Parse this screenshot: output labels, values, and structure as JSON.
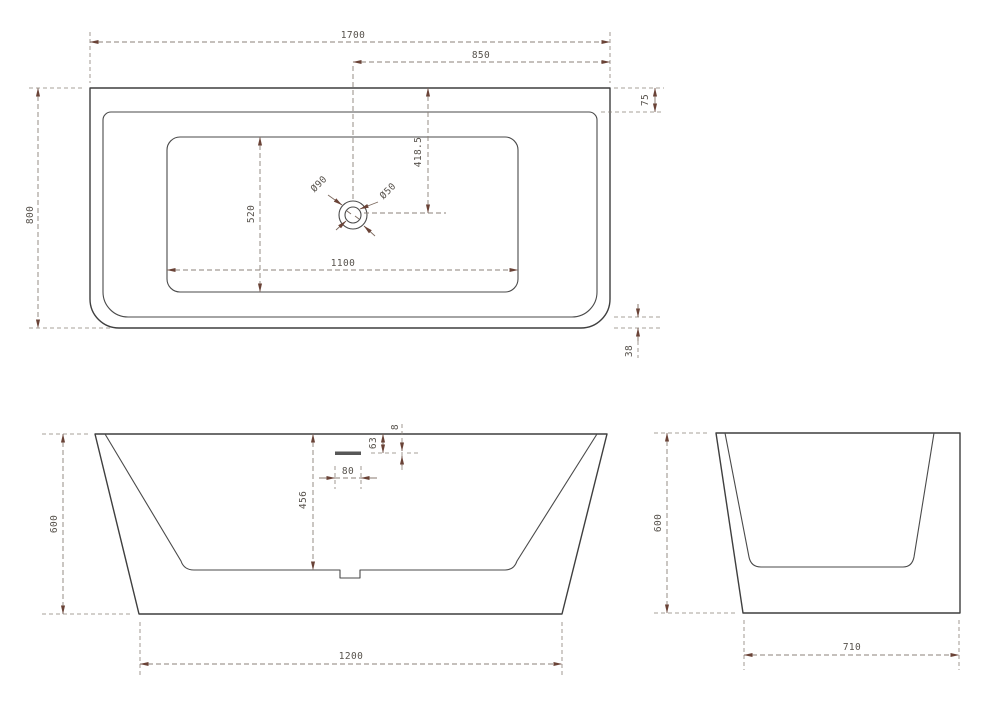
{
  "page": {
    "background": "#ffffff"
  },
  "drawing": {
    "name": "Back-to-wall bathtub technical drawing, three orthographic views",
    "colors": {
      "outline": "#3f3f3f",
      "dimension_line": "#8b8178",
      "arrowhead": "#6a4337",
      "label_text": "#57524c"
    },
    "top_view": {
      "dim_overall_length": "1700",
      "dim_drain_to_end": "850",
      "dim_back_rim": "75",
      "dim_overall_width": "800",
      "dim_drain_offset": "418.5",
      "dim_basin_width": "520",
      "dim_drain_outer": "Ø90",
      "dim_drain_inner": "Ø50",
      "dim_basin_length": "1100",
      "dim_front_rim": "38"
    },
    "front_view": {
      "dim_height": "600",
      "dim_rim_to_floor": "456",
      "dim_overflow_width": "80",
      "dim_overflow_from_rim": "63",
      "dim_overflow_slot": "8",
      "dim_base_length": "1200"
    },
    "side_view": {
      "dim_height": "600",
      "dim_base_width": "710"
    }
  }
}
